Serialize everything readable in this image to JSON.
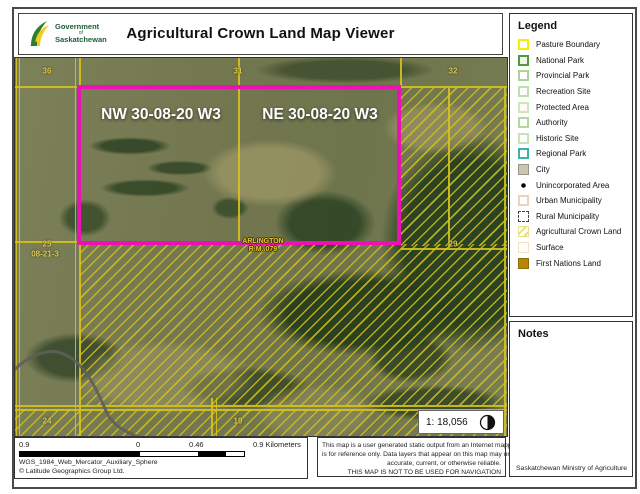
{
  "header": {
    "title": "Agricultural Crown Land Map Viewer",
    "logo": {
      "line1": "Government",
      "line2": "of",
      "line3": "Saskatchewan"
    }
  },
  "legend": {
    "title": "Legend",
    "items": [
      {
        "label": "Pasture Boundary",
        "swatch_style": "border:2px solid #f4ee00;background:#ffffff"
      },
      {
        "label": "National Park",
        "swatch_style": "border:2px solid #4f9a41;background:#edf6e8"
      },
      {
        "label": "Provincial Park",
        "swatch_style": "border:2px solid #a6d595;background:#ffffff"
      },
      {
        "label": "Recreation Site",
        "swatch_style": "border:2px solid #bce0ac;background:#fbfdf8"
      },
      {
        "label": "Protected Area",
        "swatch_style": "border:2px solid #cfe6c0;background:#fdfdf6"
      },
      {
        "label": "Authority",
        "swatch_style": "border:2px solid #b2d8a2;background:#ffffff"
      },
      {
        "label": "Historic Site",
        "swatch_style": "border:2px solid #c6e2b6;background:#ffffff"
      },
      {
        "label": "Regional Park",
        "swatch_style": "border:2px solid #3ab4a2;background:#ffffff"
      },
      {
        "label": "City",
        "swatch_style": "border:1px solid #9a9488;background:#ccc4b4"
      },
      {
        "label": "Unincorporated Area",
        "swatch_style": "border:none;background:radial-gradient(circle at 50% 50%, #000 0 2px, transparent 2.5px)"
      },
      {
        "label": "Urban Municipality",
        "swatch_style": "border:2px solid #ecd2bd;background:#ffffff"
      },
      {
        "label": "Rural Municipality",
        "swatch_style": "border:1.5px dashed #444;background:#ffffff"
      },
      {
        "label": "Agricultural Crown Land",
        "swatch_style": "border:1px solid #e6df96;background:repeating-linear-gradient(135deg, #fffef2 0 4px, #e8d94f 4px 5.5px)"
      },
      {
        "label": "Surface",
        "swatch_style": "border:1px solid #efe3cc;background:#fffdf4"
      },
      {
        "label": "First Nations Land",
        "swatch_style": "border:1px solid #8a6c08;background:#b8860b"
      }
    ]
  },
  "notes": {
    "title": "Notes",
    "footer": "Saskatchewan Ministry of Agriculture"
  },
  "map": {
    "quarter_labels": [
      "NW 30-08-20 W3",
      "NE 30-08-20 W3"
    ],
    "section_labels": [
      "36",
      "31",
      "32",
      "25",
      "08-21-3",
      "29",
      "24",
      "19"
    ],
    "rm_label": {
      "line1": "ARLINGTON",
      "line2": "R.M. 079"
    },
    "scale_text": "1: 18,056"
  },
  "scalebar": {
    "labels": [
      "0.9",
      "0",
      "0.46",
      "0.9 Kilometers"
    ],
    "projection": "WGS_1984_Web_Mercator_Auxiliary_Sphere",
    "copyright": "© Latitude Geographics Group Ltd."
  },
  "disclaimer": {
    "lines": [
      "This map is a user generated static output from an Internet mapping site and",
      "is for reference only. Data layers that appear on this map may or may not be",
      "accurate, current, or otherwise reliable.",
      "THIS MAP IS NOT TO BE USED FOR NAVIGATION"
    ]
  },
  "colors": {
    "highlight_rectangle": "#ed10b5",
    "hatch_yellow": "#d4be19",
    "logo_green": "#1c5c38",
    "logo_yellow": "#f2cf1d",
    "first_nations_fill": "#b8860b"
  }
}
